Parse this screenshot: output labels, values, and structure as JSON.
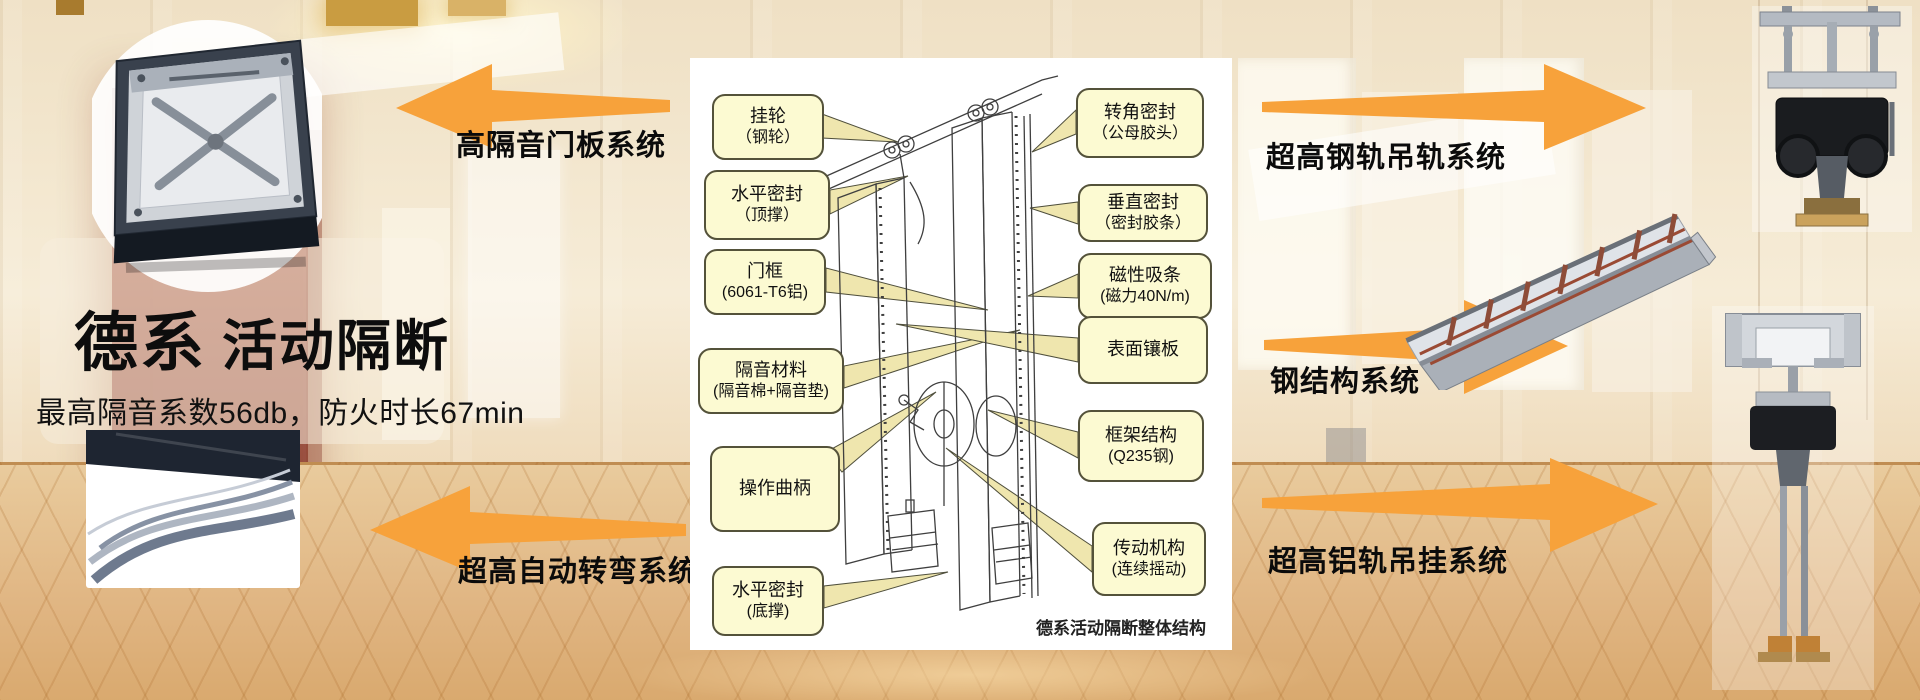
{
  "hero": {
    "brand_bold": "德系",
    "brand_rest": "活动隔断",
    "subtitle": "最高隔音系数56db，防火时长67min"
  },
  "system_labels": {
    "top_left": "高隔音门板系统",
    "bottom_left": "超高自动转弯系统",
    "top_right": "超高钢轨吊轨系统",
    "middle_right": "钢结构系统",
    "bottom_right": "超高铝轨吊挂系统"
  },
  "diagram": {
    "caption": "德系活动隔断整体结构",
    "callouts_left": [
      {
        "line1": "挂轮",
        "line2": "（钢轮）"
      },
      {
        "line1": "水平密封",
        "line2": "（顶撑）"
      },
      {
        "line1": "门框",
        "line2": "(6061-T6铝)"
      },
      {
        "line1": "隔音材料",
        "line2": "(隔音棉+隔音垫)"
      },
      {
        "line1": "操作曲柄",
        "line2": ""
      },
      {
        "line1": "水平密封",
        "line2": "(底撑)"
      }
    ],
    "callouts_right": [
      {
        "line1": "转角密封",
        "line2": "（公母胶头）"
      },
      {
        "line1": "垂直密封",
        "line2": "（密封胶条）"
      },
      {
        "line1": "磁性吸条",
        "line2": "(磁力40N/m)"
      },
      {
        "line1": "表面镶板",
        "line2": ""
      },
      {
        "line1": "框架结构",
        "line2": "(Q235钢)"
      },
      {
        "line1": "传动机构",
        "line2": "(连续摇动)"
      }
    ]
  },
  "colors": {
    "arrow_orange": "#F7A23B",
    "callout_fill": "#FCFAD2",
    "callout_border": "#54523A",
    "pointer_fill": "#EFE6AE",
    "pillar_maroon": "#9C4434",
    "carpet_tan": "#E0B582"
  }
}
